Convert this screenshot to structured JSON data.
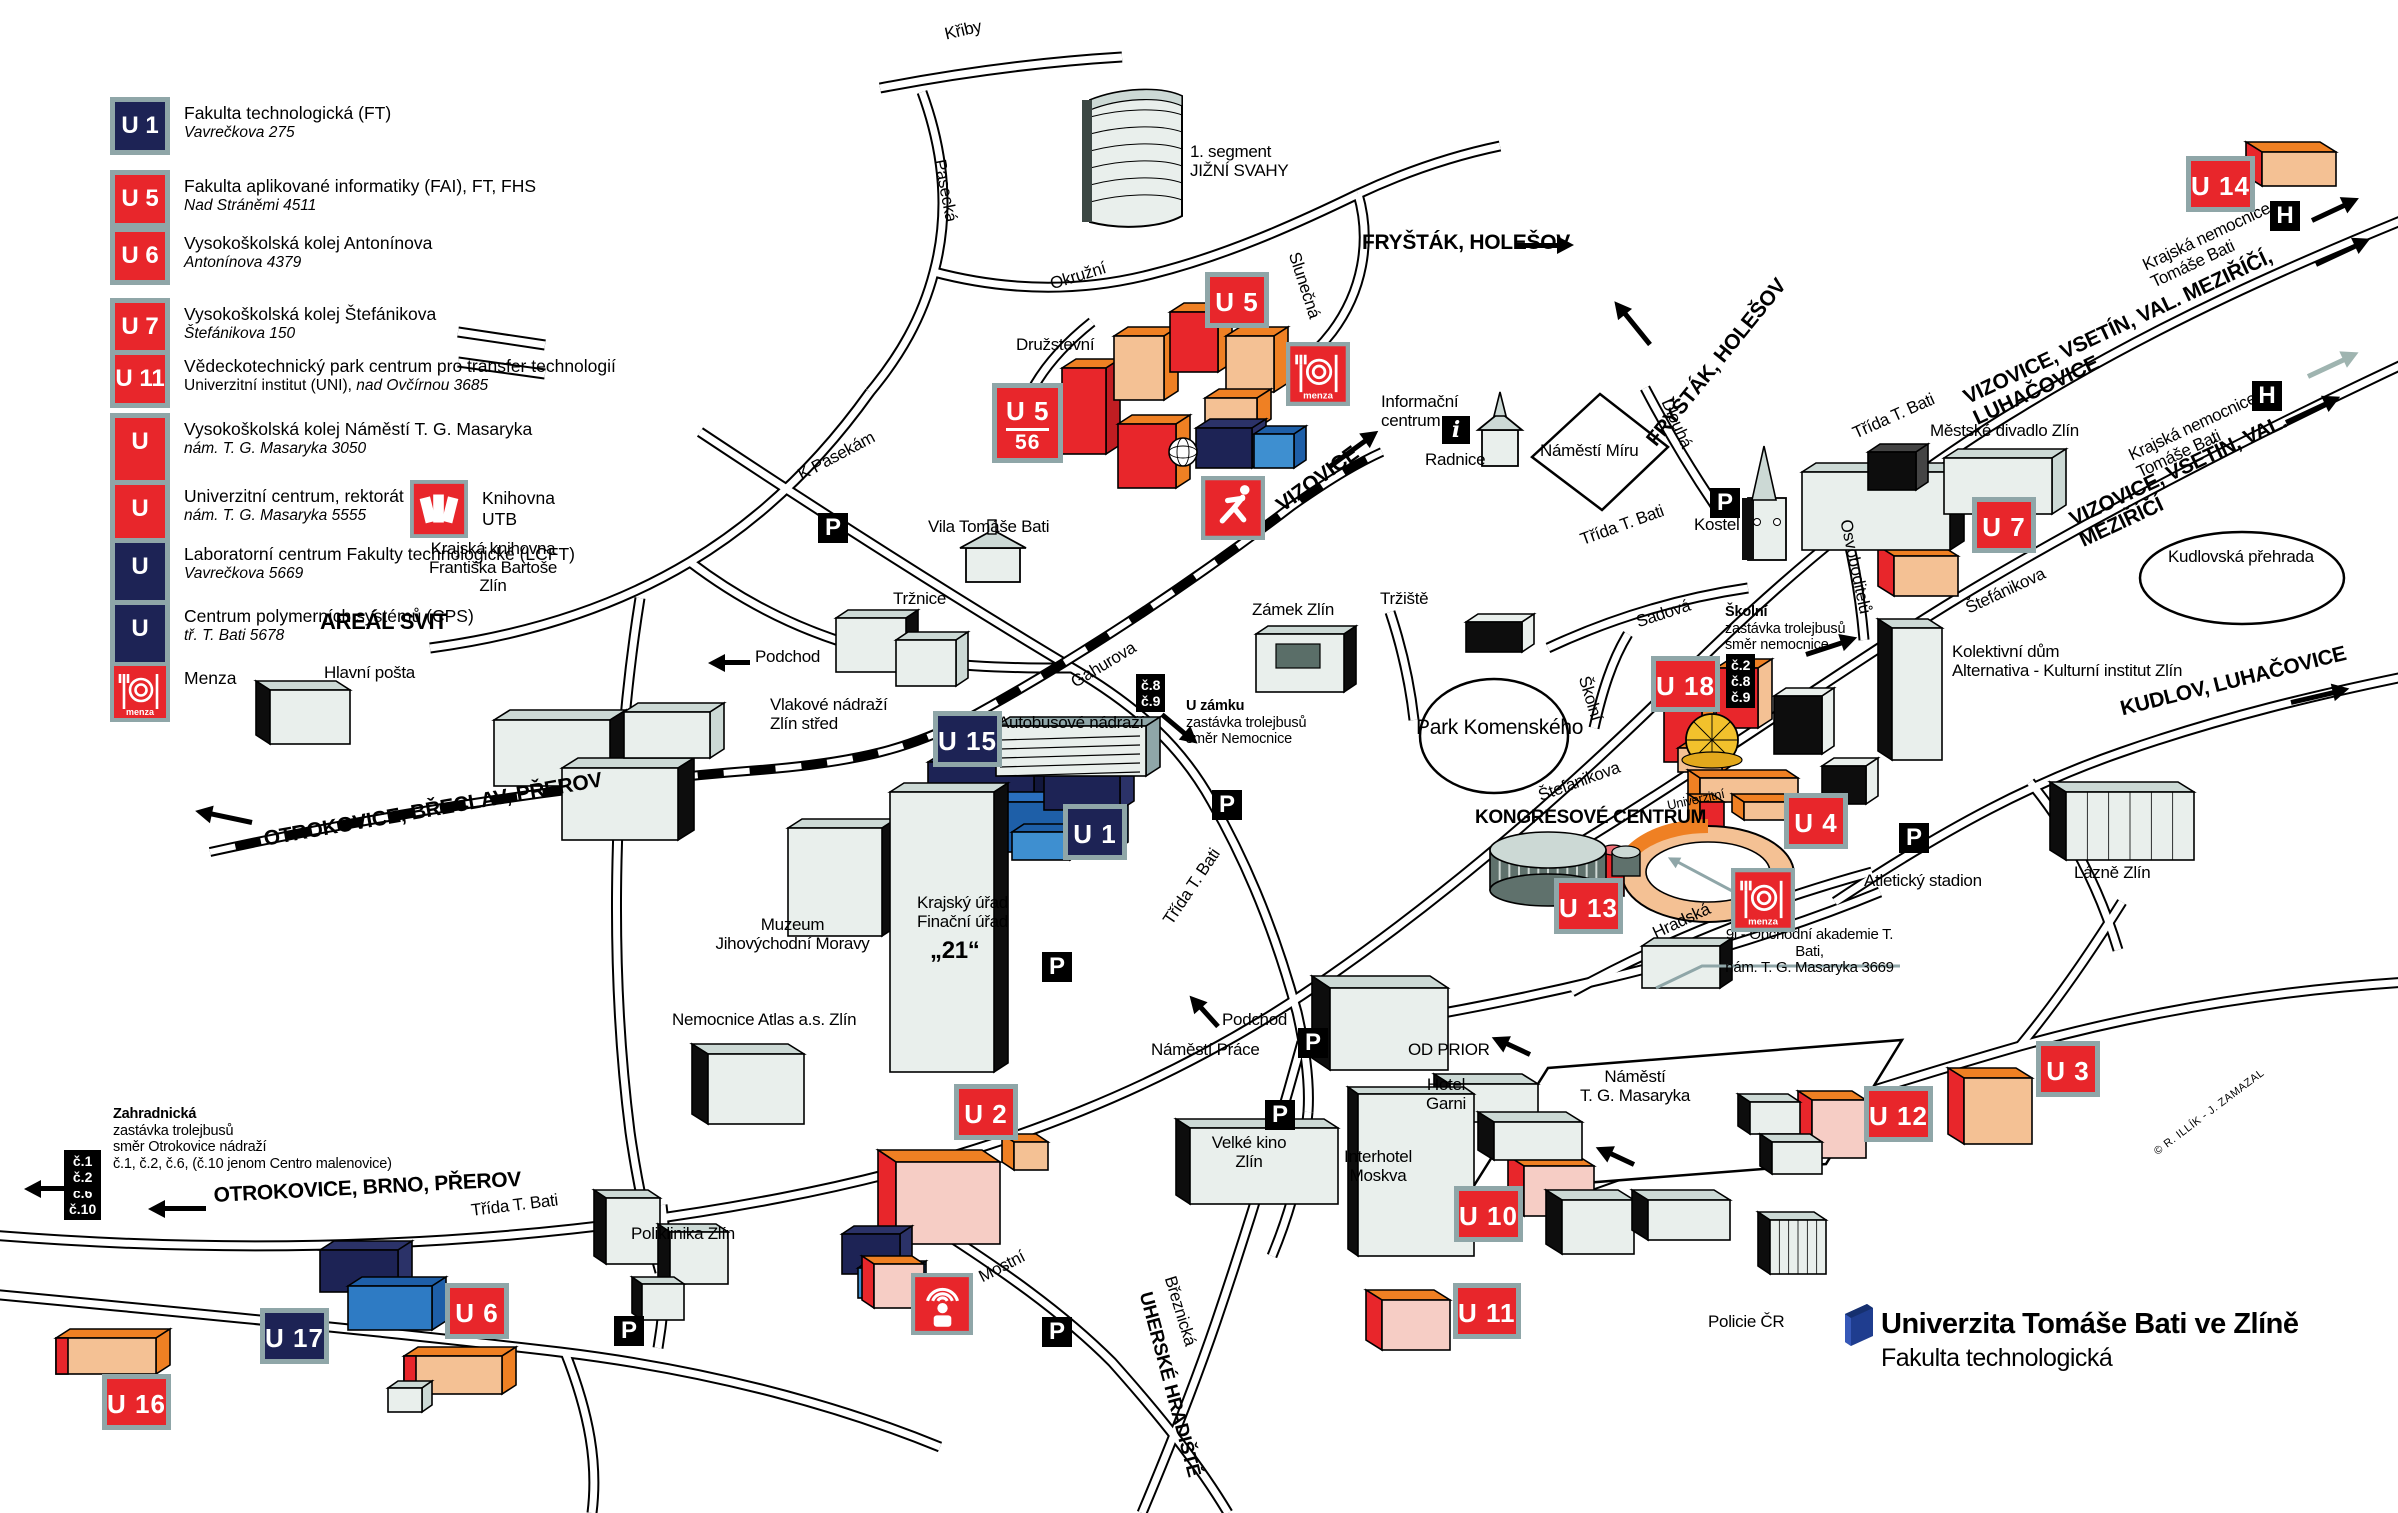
{
  "title": "Plán kampusu - Univerzita Tomáše Bati ve Zlíně",
  "logo": {
    "university": "Univerzita Tomáše Bati ve Zlíně",
    "faculty": "Fakulta technologická"
  },
  "copyright": "© R. ILLÍK - J. ZAMAZAL",
  "colors": {
    "badge_red": "#e8262b",
    "badge_navy": "#1d2355",
    "badge_border": "#8fa6a8",
    "building_orange": "#ef8023",
    "building_orange_light": "#f4c194",
    "building_pink": "#f6cdc5",
    "building_red": "#e8262b",
    "building_navy": "#1d2355",
    "building_blue": "#1e5fa8",
    "building_light_blue": "#3e8fd0",
    "building_gray": "#e9efec",
    "accent_teal": "#8fa6a8",
    "dome_yellow": "#f2c12c",
    "logo_blue": "#1f3d8f"
  },
  "legend": {
    "items": [
      {
        "id": "U 1",
        "color": "navy",
        "label": "Fakulta technologická (FT)",
        "address": "Vavrečkova 275"
      },
      {
        "id": "U 5",
        "color": "red",
        "label": "Fakulta aplikované informatiky (FAI), FT, FHS",
        "address": "Nad Stráněmi 4511"
      },
      {
        "id": "U 6",
        "color": "red",
        "label": "Vysokoškolská kolej Antonínova",
        "address": "Antonínova 4379"
      },
      {
        "id": "U 7",
        "color": "red",
        "label": "Vysokoškolská kolej Štefánikova",
        "address": "Štefánikova 150"
      },
      {
        "id": "U 11",
        "color": "red",
        "label": "Vědeckotechnický park centrum pro transfer technologií",
        "label2": "Univerzitní institut (UNI), ",
        "address": "nad Ovčírnou 3685",
        "inline_address": true
      },
      {
        "id": "U 12",
        "color": "red",
        "label": "Vysokoškolská kolej Náměstí T. G. Masaryka",
        "address": "nám. T. G. Masaryka 3050"
      },
      {
        "id": "U 13",
        "color": "red",
        "label": "Univerzitní centrum, rektorát",
        "address": "nám. T. G. Masaryka 5555",
        "extra_icon": "books",
        "extra_label": "Knihovna UTB"
      },
      {
        "id": "U 15",
        "color": "navy",
        "label": "Laboratorní centrum Fakulty technologické (LCFT)",
        "address": "Vavrečkova 5669"
      },
      {
        "id": "U 17",
        "color": "navy",
        "label": "Centrum polymerních systémů (CPS)",
        "address": "tř. T. Bati 5678"
      },
      {
        "id": "menza",
        "color": "red",
        "icon": "menza",
        "label": "Menza",
        "address": ""
      }
    ]
  },
  "map": {
    "badges": [
      {
        "n": "badge-u5-56",
        "t": "U 5",
        "sub": "56",
        "x": 992,
        "y": 383,
        "c": "red"
      },
      {
        "n": "badge-u5",
        "t": "U 5",
        "x": 1205,
        "y": 272,
        "c": "red"
      },
      {
        "n": "badge-u14",
        "t": "U 14",
        "x": 2186,
        "y": 156,
        "c": "red"
      },
      {
        "n": "badge-u15",
        "t": "U 15",
        "x": 933,
        "y": 711,
        "c": "navy"
      },
      {
        "n": "badge-u1",
        "t": "U 1",
        "x": 1063,
        "y": 804,
        "c": "navy"
      },
      {
        "n": "badge-u18",
        "t": "U 18",
        "x": 1651,
        "y": 656,
        "c": "red"
      },
      {
        "n": "badge-u7",
        "t": "U 7",
        "x": 1972,
        "y": 497,
        "c": "red"
      },
      {
        "n": "badge-u13",
        "t": "U 13",
        "x": 1554,
        "y": 878,
        "c": "red"
      },
      {
        "n": "badge-u4",
        "t": "U 4",
        "x": 1784,
        "y": 793,
        "c": "red"
      },
      {
        "n": "badge-u2",
        "t": "U 2",
        "x": 954,
        "y": 1084,
        "c": "red"
      },
      {
        "n": "badge-u17",
        "t": "U 17",
        "x": 260,
        "y": 1308,
        "c": "navy"
      },
      {
        "n": "badge-u6",
        "t": "U 6",
        "x": 445,
        "y": 1283,
        "c": "red"
      },
      {
        "n": "badge-u16",
        "t": "U 16",
        "x": 102,
        "y": 1374,
        "c": "red"
      },
      {
        "n": "badge-u10",
        "t": "U 10",
        "x": 1454,
        "y": 1186,
        "c": "red"
      },
      {
        "n": "badge-u11",
        "t": "U 11",
        "x": 1453,
        "y": 1283,
        "c": "red"
      },
      {
        "n": "badge-u12",
        "t": "U 12",
        "x": 1864,
        "y": 1086,
        "c": "red"
      },
      {
        "n": "badge-u3",
        "t": "U 3",
        "x": 2036,
        "y": 1041,
        "c": "red"
      }
    ],
    "labels": [
      {
        "n": "street-kriby",
        "t": "Křiby",
        "x": 943,
        "y": 26,
        "r": -13
      },
      {
        "n": "street-pasecka",
        "t": "Pasecká",
        "x": 948,
        "y": 158,
        "r": 79
      },
      {
        "n": "place-jizni-svahy",
        "t": "1. segment\nJIŽNÍ SVAHY",
        "x": 1190,
        "y": 143
      },
      {
        "n": "dir-frystak-holesov-1",
        "t": "FRYŠTÁK, HOLEŠOV",
        "x": 1362,
        "y": 231,
        "b": 1,
        "s": 21
      },
      {
        "n": "street-okruzni",
        "t": "Okružní",
        "x": 1048,
        "y": 276,
        "r": -17
      },
      {
        "n": "street-slunecna",
        "t": "Slunečná",
        "x": 1302,
        "y": 250,
        "r": 72
      },
      {
        "n": "street-druzstevni",
        "t": "Družstevní",
        "x": 1016,
        "y": 336
      },
      {
        "n": "street-k-pasekam",
        "t": "K Pasekám",
        "x": 795,
        "y": 468,
        "r": -28
      },
      {
        "n": "place-vila-tomase-bati",
        "t": "Vila Tomáše Bati",
        "x": 928,
        "y": 518
      },
      {
        "n": "place-zamek-zlin",
        "t": "Zámek Zlín",
        "x": 1252,
        "y": 601
      },
      {
        "n": "street-trziste",
        "t": "Tržiště",
        "x": 1380,
        "y": 590
      },
      {
        "n": "place-informacni-centrum",
        "t": "Informační\ncentrum",
        "x": 1381,
        "y": 393
      },
      {
        "n": "place-radnice",
        "t": "Radnice",
        "x": 1425,
        "y": 451
      },
      {
        "n": "place-namesti-miru",
        "t": "Náměstí Míru",
        "x": 1540,
        "y": 442
      },
      {
        "n": "dir-vizovice",
        "t": "VIZOVICE",
        "x": 1272,
        "y": 498,
        "r": -36,
        "b": 1,
        "s": 21
      },
      {
        "n": "street-trida-t-bati-kostel",
        "t": "Třída T. Bati",
        "x": 1578,
        "y": 532,
        "r": -20
      },
      {
        "n": "street-dlouha",
        "t": "Dlouhá",
        "x": 1674,
        "y": 396,
        "r": 66
      },
      {
        "n": "dir-frystak-holesov-2",
        "t": "FRYŠTÁK, HOLEŠOV",
        "x": 1642,
        "y": 436,
        "r": -51,
        "b": 1,
        "s": 21
      },
      {
        "n": "place-kostel",
        "t": "Kostel",
        "x": 1694,
        "y": 516
      },
      {
        "n": "street-trida-t-bati-ne",
        "t": "Třída T. Bati",
        "x": 1850,
        "y": 426,
        "r": -24
      },
      {
        "n": "dir-vizovice-vsetin-luhacovice",
        "t": "VIZOVICE, VSETÍN, VAL. MEZIŘÍČÍ, LUHAČOVICE",
        "x": 1960,
        "y": 388,
        "r": -25,
        "b": 1,
        "s": 21
      },
      {
        "n": "place-krajska-nemocnice-1",
        "t": "Krajská nemocnice\nTomáše Bati",
        "x": 2140,
        "y": 258,
        "r": -25
      },
      {
        "n": "place-mestske-divadlo",
        "t": "Městské divadlo Zlín",
        "x": 1930,
        "y": 422
      },
      {
        "n": "street-stefanikova-ne",
        "t": "Štefánikova",
        "x": 1963,
        "y": 601,
        "r": -25
      },
      {
        "n": "place-kudlovska-prehrada",
        "t": "Kudlovská přehrada",
        "x": 2168,
        "y": 548
      },
      {
        "n": "place-krajska-nemocnice-2",
        "t": "Krajská nemocnice\nTomáše Bati",
        "x": 2126,
        "y": 448,
        "r": -25
      },
      {
        "n": "dir-vizovice-vsetin-mezirici",
        "t": "VIZOVICE, VSETÍN, VAL. MEZIŘÍČÍ",
        "x": 2066,
        "y": 510,
        "r": -25,
        "b": 1,
        "s": 21
      },
      {
        "n": "street-osvoboditelu",
        "t": "Osvoboditelů",
        "x": 1854,
        "y": 518,
        "r": 78
      },
      {
        "n": "place-kolektivni-dum",
        "t": "Kolektivní dům\nAlternativa - Kulturní institut Zlín",
        "x": 1952,
        "y": 643
      },
      {
        "n": "dir-kudlov-luhacovice",
        "t": "KUDLOV, LUHAČOVICE",
        "x": 2118,
        "y": 698,
        "r": -14,
        "b": 1,
        "s": 21
      },
      {
        "n": "street-sadova",
        "t": "Sadová",
        "x": 1634,
        "y": 614,
        "r": -18
      },
      {
        "n": "street-skolni",
        "t": "Školní",
        "x": 1592,
        "y": 674,
        "r": 73
      },
      {
        "n": "place-park-komenskeho",
        "t": "Park Komenského",
        "x": 1416,
        "y": 716,
        "s": 21
      },
      {
        "n": "street-stefanikova-sw",
        "t": "Štefánikova",
        "x": 1536,
        "y": 788,
        "r": -20
      },
      {
        "n": "place-kongresove-centrum",
        "t": "KONGRESOVÉ CENTRUM",
        "x": 1475,
        "y": 808,
        "b": 1,
        "s": 19
      },
      {
        "n": "street-univerzitni",
        "t": "Univerzitní",
        "x": 1666,
        "y": 799,
        "r": -12,
        "s": 13
      },
      {
        "n": "street-hradska",
        "t": "Hradská",
        "x": 1650,
        "y": 926,
        "r": -25
      },
      {
        "n": "place-atleticky-stadion",
        "t": "Atletický stadion",
        "x": 1864,
        "y": 872
      },
      {
        "n": "place-obchodni-akademie",
        "t": "9l - Obchodní akademie T. Bati,\nnám. T. G. Masaryka 3669",
        "x": 1712,
        "y": 927,
        "s": 15,
        "c": 1,
        "w": 195
      },
      {
        "n": "place-lazne-zlin",
        "t": "Lázně Zlín",
        "x": 2074,
        "y": 864
      },
      {
        "n": "place-vlakove-nadrazi",
        "t": "Vlakové nádraží\nZlín střed",
        "x": 770,
        "y": 696
      },
      {
        "n": "place-autobusove-nadrazi",
        "t": "Autobusové nádraží",
        "x": 998,
        "y": 714
      },
      {
        "n": "street-gahurova",
        "t": "Gahurova",
        "x": 1068,
        "y": 676,
        "r": -31
      },
      {
        "n": "street-trida-t-bati-stred",
        "t": "Třída T. Bati",
        "x": 1160,
        "y": 918,
        "r": -56
      },
      {
        "n": "dir-otrokovice-breclav-prerov",
        "t": "OTROKOVICE, BŘECLAV, PŘEROV",
        "x": 262,
        "y": 828,
        "r": -10,
        "b": 1,
        "s": 21
      },
      {
        "n": "place-areal-svit",
        "t": "AREÁL SVIT",
        "x": 320,
        "y": 610,
        "b": 1,
        "s": 22
      },
      {
        "n": "place-krajska-knihovna",
        "t": "Krajská knihovna\nFrantiška Bartoše\nZlín",
        "x": 418,
        "y": 540,
        "c": 1,
        "w": 150
      },
      {
        "n": "place-muzeum",
        "t": "Muzeum\nJihovýchodní Moravy",
        "x": 700,
        "y": 916,
        "c": 1,
        "w": 185
      },
      {
        "n": "place-krajsky-urad",
        "t": "Krajský úřad\nFinační úřad",
        "x": 905,
        "y": 894,
        "c": 1,
        "w": 115
      },
      {
        "n": "place-dvacet-jedna",
        "t": "„21“",
        "x": 930,
        "y": 938,
        "b": 1,
        "s": 24
      },
      {
        "n": "place-hlavni-posta",
        "t": "Hlavní pošta",
        "x": 324,
        "y": 664
      },
      {
        "n": "place-nemocnice-atlas",
        "t": "Nemocnice Atlas a.s. Zlín",
        "x": 672,
        "y": 1011
      },
      {
        "n": "place-poliklinika-zlin",
        "t": "Poliklinika Zlín",
        "x": 631,
        "y": 1225
      },
      {
        "n": "street-mostni",
        "t": "Mostní",
        "x": 976,
        "y": 1270,
        "r": -27
      },
      {
        "n": "place-podchod-1",
        "t": "Podchod",
        "x": 755,
        "y": 648
      },
      {
        "n": "place-podchod-2",
        "t": "Podchod",
        "x": 1222,
        "y": 1011
      },
      {
        "n": "place-namesti-prace",
        "t": "Náměstí Práce",
        "x": 1151,
        "y": 1041
      },
      {
        "n": "place-velke-kino",
        "t": "Velké kino\nZlín",
        "x": 1194,
        "y": 1134,
        "c": 1,
        "w": 110
      },
      {
        "n": "place-interhotel-moskva",
        "t": "Interhotel\nMoskva",
        "x": 1328,
        "y": 1148,
        "c": 1,
        "w": 100
      },
      {
        "n": "place-od-prior",
        "t": "OD PRIOR",
        "x": 1408,
        "y": 1041
      },
      {
        "n": "place-hotel-garni",
        "t": "Hotel\nGarni",
        "x": 1411,
        "y": 1076,
        "c": 1,
        "w": 70
      },
      {
        "n": "place-namesti-tgm",
        "t": "Náměstí\nT. G. Masaryka",
        "x": 1560,
        "y": 1068,
        "c": 1,
        "w": 150
      },
      {
        "n": "street-breznicka",
        "t": "Březnická",
        "x": 1178,
        "y": 1274,
        "r": 73
      },
      {
        "n": "dir-uherske-hradiste",
        "t": "UHERSKÉ HRADIŠTĚ",
        "x": 1154,
        "y": 1290,
        "r": 75,
        "b": 1,
        "s": 19
      },
      {
        "n": "place-trznice",
        "t": "Tržnice",
        "x": 893,
        "y": 590
      },
      {
        "n": "dir-otrokovice-brno-prerov",
        "t": "OTROKOVICE, BRNO, PŘEROV",
        "x": 213,
        "y": 1184,
        "r": -3,
        "b": 1,
        "s": 21
      },
      {
        "n": "street-trida-t-bati-sw",
        "t": "Třída T. Bati",
        "x": 470,
        "y": 1202,
        "r": -7
      },
      {
        "n": "place-policie-cr",
        "t": "Policie ČR",
        "x": 1708,
        "y": 1313
      }
    ],
    "stops": [
      {
        "n": "stop-u-zamku",
        "x": 1186,
        "y": 698,
        "lines": [
          {
            "t": "U zámku",
            "b": 1
          },
          {
            "t": "zastávka trolejbusů"
          },
          {
            "t": "směr Nemocnice"
          }
        ]
      },
      {
        "n": "stop-skolni",
        "x": 1725,
        "y": 604,
        "lines": [
          {
            "t": "Školní",
            "b": 1
          },
          {
            "t": "zastávka trolejbusů"
          },
          {
            "t": "směr nemocnice"
          }
        ]
      },
      {
        "n": "stop-zahradnicka",
        "x": 113,
        "y": 1106,
        "lines": [
          {
            "t": "Zahradnická",
            "b": 1
          },
          {
            "t": "zastávka trolejbusů"
          },
          {
            "t": "směr Otrokovice nádraží"
          },
          {
            "t": "č.1, č.2, č.6, (č.10 jenom Centro malenovice)"
          }
        ]
      }
    ],
    "line_badges": [
      {
        "n": "lines-8-9",
        "x": 1136,
        "y": 674,
        "lines": [
          "č.8",
          "č.9"
        ]
      },
      {
        "n": "lines-2-8-9",
        "x": 1726,
        "y": 654,
        "lines": [
          "č.2",
          "č.8",
          "č.9"
        ]
      },
      {
        "n": "lines-1-2-6-10",
        "x": 64,
        "y": 1150,
        "lines": [
          "č.1",
          "č.2",
          "č.6",
          "č.10"
        ]
      }
    ],
    "parking": [
      [
        818,
        513
      ],
      [
        1212,
        790
      ],
      [
        1042,
        952
      ],
      [
        1298,
        1028
      ],
      [
        1265,
        1100
      ],
      [
        614,
        1316
      ],
      [
        1042,
        1317
      ],
      [
        1899,
        823
      ],
      [
        1710,
        488
      ]
    ],
    "hospital": [
      [
        2270,
        201
      ],
      [
        2252,
        381
      ]
    ],
    "info": [
      [
        1442,
        416
      ]
    ],
    "icons": [
      {
        "n": "menza-icon",
        "k": "menza",
        "x": 1286,
        "y": 342,
        "s": 64
      },
      {
        "n": "menza-icon",
        "k": "menza",
        "x": 1731,
        "y": 868,
        "s": 64
      },
      {
        "n": "sport-hall-icon",
        "k": "sport",
        "x": 1201,
        "y": 476,
        "s": 64
      },
      {
        "n": "auditorium-icon",
        "k": "auditorium",
        "x": 911,
        "y": 1273,
        "s": 62
      }
    ],
    "arrows": [
      {
        "n": "arrow-frystak-top",
        "x": 1516,
        "y": 243,
        "a": 0,
        "l": 42
      },
      {
        "n": "arrow-vizovice",
        "x": 1330,
        "y": 464,
        "a": -36,
        "l": 44
      },
      {
        "n": "arrow-frystak-2",
        "x": 1650,
        "y": 342,
        "a": -129,
        "l": 40
      },
      {
        "n": "arrow-vizovice-vsetin-luh",
        "x": 2316,
        "y": 262,
        "a": -25,
        "l": 44
      },
      {
        "n": "arrow-hospital-1",
        "x": 2312,
        "y": 218,
        "a": -25,
        "l": 36
      },
      {
        "n": "arrow-hospital-2-gray",
        "x": 2308,
        "y": 374,
        "a": -25,
        "l": 40,
        "c": "#9fb4b0"
      },
      {
        "n": "arrow-vizovice-vsetin-mez",
        "x": 2286,
        "y": 420,
        "a": -25,
        "l": 44
      },
      {
        "n": "arrow-kudlov",
        "x": 2291,
        "y": 700,
        "a": -13,
        "l": 44
      },
      {
        "n": "arrow-skolni-stop",
        "x": 1806,
        "y": 652,
        "a": -18,
        "l": 38
      },
      {
        "n": "arrow-u-zamku",
        "x": 1162,
        "y": 712,
        "a": 40,
        "l": 30
      },
      {
        "n": "arrow-podchod-1",
        "x": 750,
        "y": 660,
        "a": 180,
        "l": 26
      },
      {
        "n": "arrow-podchod-2",
        "x": 1218,
        "y": 1024,
        "a": -132,
        "l": 26
      },
      {
        "n": "arrow-otrokovice-brno",
        "x": 206,
        "y": 1206,
        "a": 180,
        "l": 42
      },
      {
        "n": "arrow-zahradnicka",
        "x": 98,
        "y": 1186,
        "a": 180,
        "l": 58
      },
      {
        "n": "arrow-otrokovice-breclav",
        "x": 252,
        "y": 820,
        "a": 192,
        "l": 42
      },
      {
        "n": "arrow-tgm-oneway-1",
        "x": 1530,
        "y": 1052,
        "a": -155,
        "l": 26
      },
      {
        "n": "arrow-tgm-oneway-2",
        "x": 1634,
        "y": 1162,
        "a": -155,
        "l": 26
      },
      {
        "n": "arrow-teal-u13",
        "x": 1752,
        "y": 900,
        "a": -152,
        "l": 84,
        "c": "#8fa6a8",
        "th": 1
      }
    ]
  }
}
